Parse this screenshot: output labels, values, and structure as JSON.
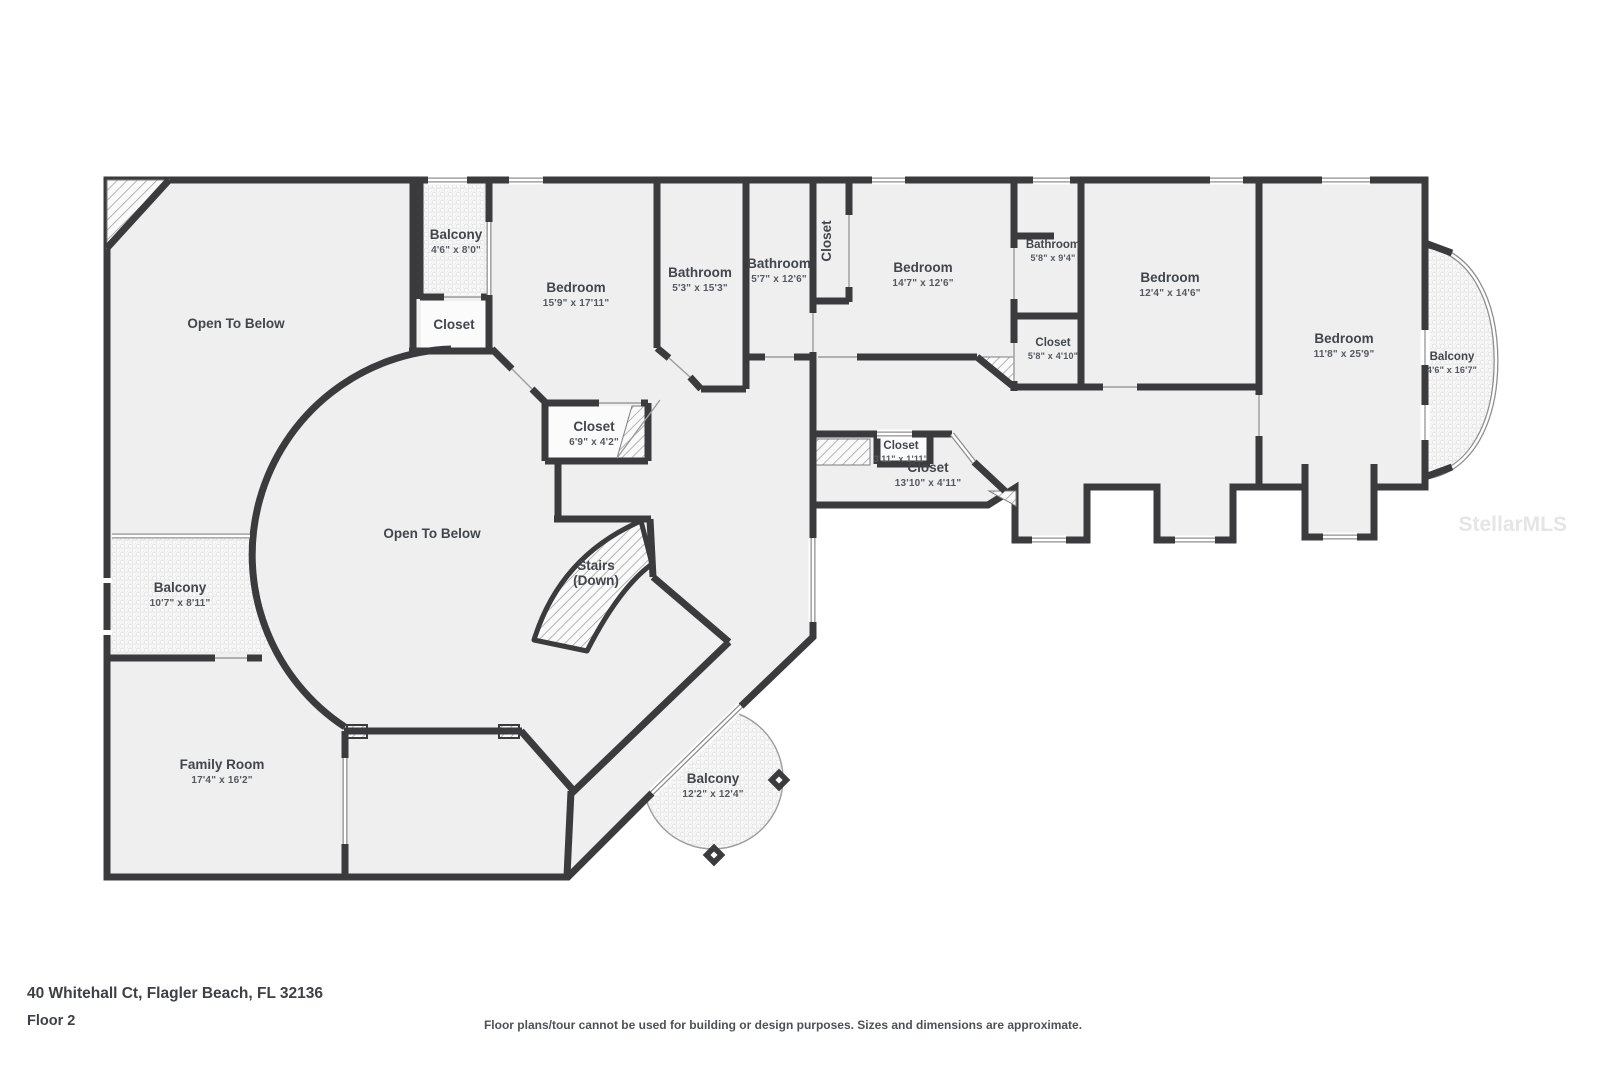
{
  "meta": {
    "address": "40 Whitehall Ct, Flagler Beach, FL 32136",
    "floor_label": "Floor 2",
    "disclaimer": "Floor plans/tour cannot be used for building or design purposes. Sizes and dimensions are approximate.",
    "watermark": "StellarMLS"
  },
  "colors": {
    "wall": "#3b3b3d",
    "floor": "#efeff0",
    "closet_interior": "#fbfbfb",
    "thin_line": "#9c9c9c",
    "label_text": "#42464b"
  },
  "rooms": [
    {
      "id": "open-to-below-upper",
      "title": "Open To Below",
      "dims": "",
      "x": 236,
      "y": 328
    },
    {
      "id": "balcony-top",
      "title": "Balcony",
      "dims": "4'6\" x 8'0\"",
      "x": 456,
      "y": 239
    },
    {
      "id": "closet-balcony-top",
      "title": "Closet",
      "dims": "",
      "x": 454,
      "y": 329
    },
    {
      "id": "bedroom-1",
      "title": "Bedroom",
      "dims": "15'9\" x 17'11\"",
      "x": 576,
      "y": 292
    },
    {
      "id": "bathroom-1",
      "title": "Bathroom",
      "dims": "5'3\" x 15'3\"",
      "x": 700,
      "y": 277
    },
    {
      "id": "bathroom-2",
      "title": "Bathroom",
      "dims": "5'7\" x 12'6\"",
      "x": 779,
      "y": 268
    },
    {
      "id": "closet-vertical",
      "title": "Closet",
      "dims": "",
      "x": 831,
      "y": 241,
      "rot": -90
    },
    {
      "id": "bedroom-2",
      "title": "Bedroom",
      "dims": "14'7\" x 12'6\"",
      "x": 923,
      "y": 272
    },
    {
      "id": "bathroom-3",
      "title": "Bathroom",
      "dims": "5'8\" x 9'4\"",
      "x": 1053,
      "y": 248,
      "small": true
    },
    {
      "id": "closet-1",
      "title": "Closet",
      "dims": "5'8\" x 4'10\"",
      "x": 1053,
      "y": 346,
      "small": true
    },
    {
      "id": "bedroom-3",
      "title": "Bedroom",
      "dims": "12'4\" x 14'6\"",
      "x": 1170,
      "y": 282
    },
    {
      "id": "bedroom-4",
      "title": "Bedroom",
      "dims": "11'8\" x 25'9\"",
      "x": 1344,
      "y": 343
    },
    {
      "id": "balcony-right",
      "title": "Balcony",
      "dims": "4'6\" x 16'7\"",
      "x": 1452,
      "y": 360,
      "small": true
    },
    {
      "id": "closet-2",
      "title": "Closet",
      "dims": "6'9\" x 4'2\"",
      "x": 594,
      "y": 431
    },
    {
      "id": "closet-3",
      "title": "Closet",
      "dims": "3'11\" x 1'11\"",
      "x": 901,
      "y": 449,
      "small": true
    },
    {
      "id": "closet-4",
      "title": "Closet",
      "dims": "13'10\" x 4'11\"",
      "x": 928,
      "y": 472
    },
    {
      "id": "open-to-below-main",
      "title": "Open To Below",
      "dims": "",
      "x": 432,
      "y": 538
    },
    {
      "id": "stairs",
      "title": "Stairs",
      "title2": "(Down)",
      "dims": "",
      "x": 596,
      "y": 570
    },
    {
      "id": "balcony-left",
      "title": "Balcony",
      "dims": "10'7\" x 8'11\"",
      "x": 180,
      "y": 592
    },
    {
      "id": "family-room",
      "title": "Family Room",
      "dims": "17'4\" x 16'2\"",
      "x": 222,
      "y": 769
    },
    {
      "id": "balcony-round",
      "title": "Balcony",
      "dims": "12'2\" x 12'4\"",
      "x": 713,
      "y": 783
    }
  ]
}
